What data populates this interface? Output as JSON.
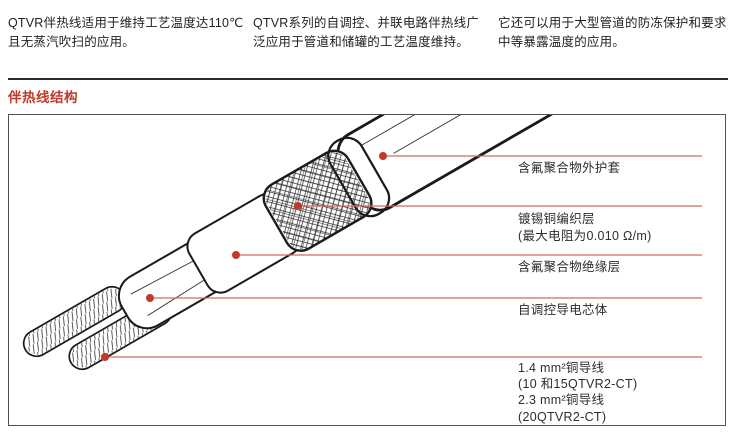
{
  "intro": {
    "col1": "QTVR伴热线适用于维持工艺温度达110℃且无蒸汽吹扫的应用。",
    "col2": "QTVR系列的自调控、并联电路伴热线广泛应用于管道和储罐的工艺温度维持。",
    "col3": "它还可以用于大型管道的防冻保护和要求中等暴露温度的应用。"
  },
  "section": {
    "title": "伴热线结构"
  },
  "diagram": {
    "callouts": [
      {
        "part": "outer-jacket",
        "lines": [
          "含氟聚合物外护套"
        ]
      },
      {
        "part": "tinned-copper-braid",
        "lines": [
          "镀锡铜编织层",
          "(最大电阻为0.010 Ω/m)"
        ]
      },
      {
        "part": "fluoropolymer-insulation",
        "lines": [
          "含氟聚合物绝缘层"
        ]
      },
      {
        "part": "self-regulating-core",
        "lines": [
          "自调控导电芯体"
        ]
      },
      {
        "part": "copper-bus-wires",
        "lines": [
          "1.4 mm²铜导线",
          "(10 和15QTVR2-CT)",
          "2.3 mm²铜导线",
          "(20QTVR2-CT)"
        ]
      }
    ],
    "colors": {
      "heading_red": "#c0392b",
      "callout_line": "#cf6a5f",
      "callout_dot": "#c0392b",
      "outline": "#1a1a1a",
      "box_border": "#515151"
    }
  }
}
